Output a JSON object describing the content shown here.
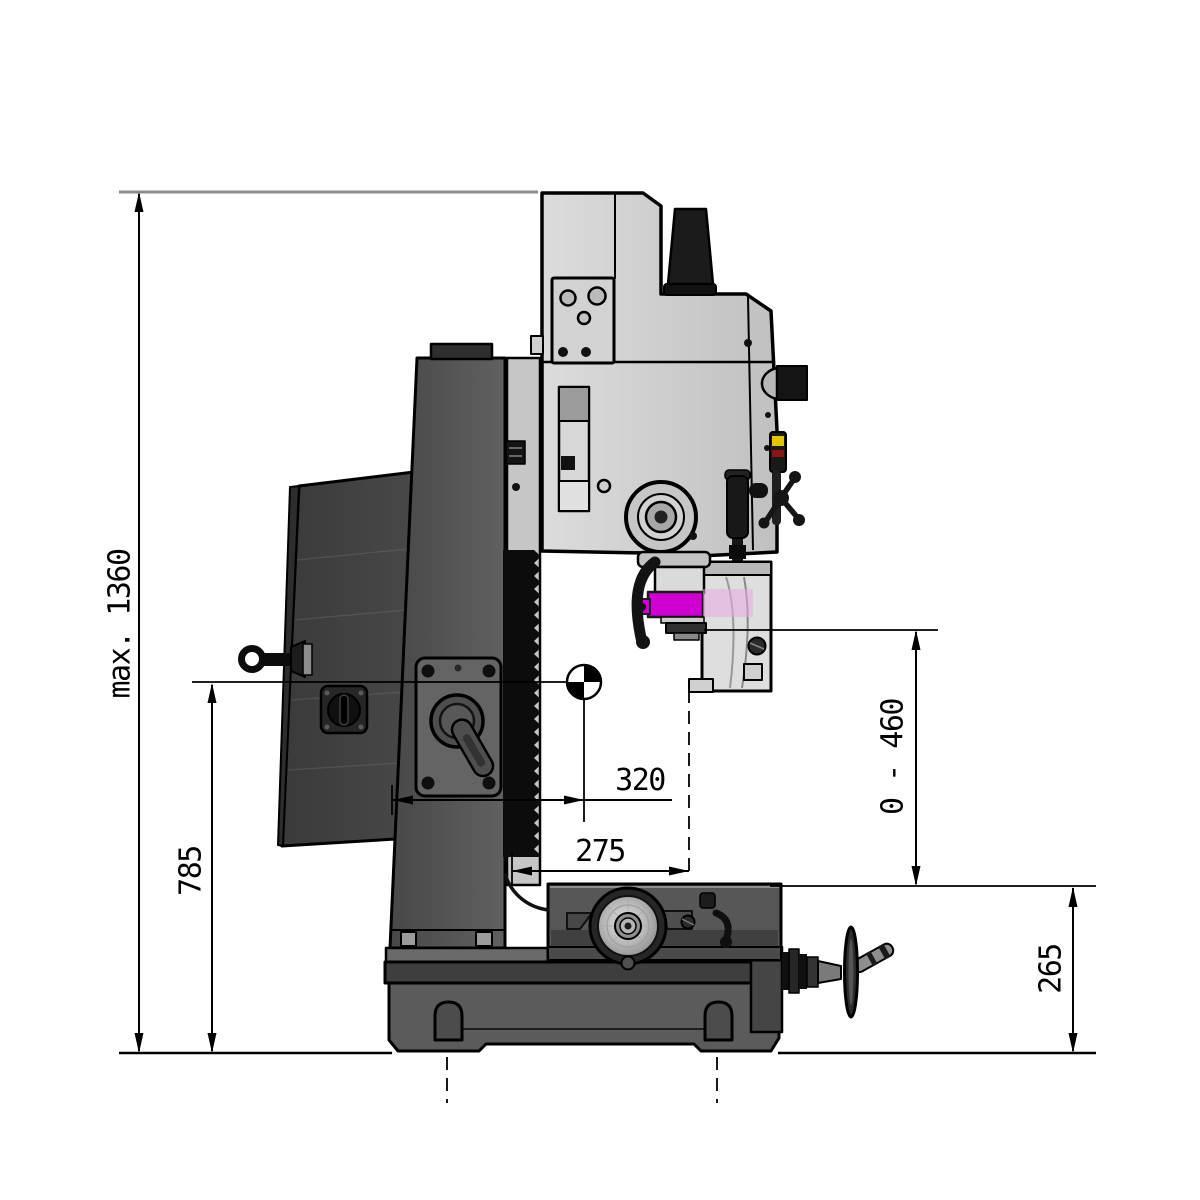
{
  "drawing": {
    "title": "bench-milling-machine-side-view-dimension-drawing",
    "dimensions": {
      "overall_height": {
        "label": "max. 1360"
      },
      "datum_height": {
        "label": "785"
      },
      "upper_reach": {
        "label": "320"
      },
      "lower_reach": {
        "label": "275"
      },
      "spindle_to_table": {
        "label": "0 - 460"
      },
      "table_height": {
        "label": "265"
      }
    },
    "colors": {
      "background": "#ffffff",
      "outline": "#000000",
      "head_light_gray": "#cfcfcf",
      "column_dark_gray": "#525252",
      "cover_gray": "#414141",
      "accent_magenta": "#cc00cc",
      "accent_pink": "#e9aade",
      "accent_yellow": "#e2c400"
    }
  }
}
